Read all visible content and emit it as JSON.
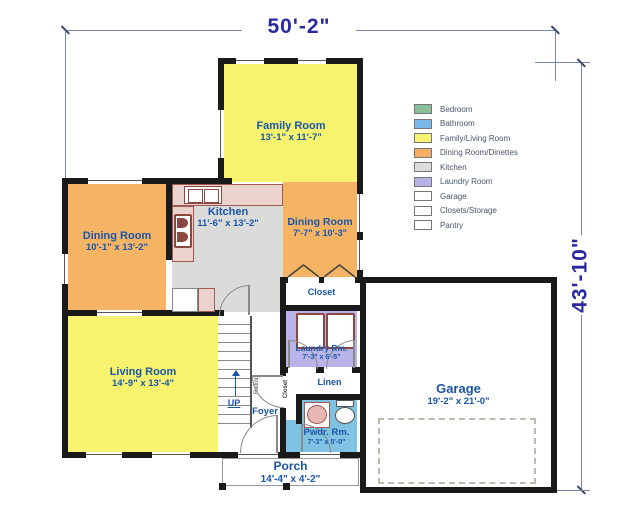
{
  "dimensions": {
    "width_label": "50'-2\"",
    "height_label": "43'-10\""
  },
  "rooms": {
    "family": {
      "name": "Family Room",
      "dims": "13'-1\" x 11'-7\""
    },
    "dining1": {
      "name": "Dining Room",
      "dims": "10'-1\" x 13'-2\""
    },
    "kitchen": {
      "name": "Kitchen",
      "dims": "11'-6\" x 13'-2\""
    },
    "dining2": {
      "name": "Dining Room",
      "dims": "7'-7\" x 10'-3\""
    },
    "living": {
      "name": "Living Room",
      "dims": "14'-9\" x 13'-4\""
    },
    "laundry": {
      "name": "Laundry Rm.",
      "dims": "7'-3\" x 6'-5\""
    },
    "powder": {
      "name": "Pwdr. Rm.",
      "dims": "7'-3\" x 5'-0\""
    },
    "garage": {
      "name": "Garage",
      "dims": "19'-2\" x 21'-0\""
    },
    "porch": {
      "name": "Porch",
      "dims": "14'-4\" x 4'-2\""
    },
    "closet": {
      "name": "Closet"
    },
    "linen": {
      "name": "Linen"
    },
    "foyer_closet": {
      "name": "Closet"
    },
    "foyer": {
      "name": "Foyer"
    },
    "stairs": {
      "name": "UP"
    },
    "railing": {
      "name": "Railing"
    }
  },
  "legend": {
    "items": [
      {
        "label": "Bedroom",
        "color": "#8abf9c"
      },
      {
        "label": "Bathroom",
        "color": "#77b7ea"
      },
      {
        "label": "Family/Living Room",
        "color": "#f8f473"
      },
      {
        "label": "Dining Room/Dinettes",
        "color": "#f4ad62"
      },
      {
        "label": "Kitchen",
        "color": "#dcdcdc"
      },
      {
        "label": "Laundry Room",
        "color": "#b7b2e6"
      },
      {
        "label": "Garage",
        "color": "#ffffff"
      },
      {
        "label": "Closets/Storage",
        "color": "#ffffff"
      },
      {
        "label": "Pantry",
        "color": "#ffffff"
      }
    ]
  },
  "colors": {
    "wall": "#1a1a1a",
    "family_living": "#f7f36e",
    "dining": "#f5b364",
    "kitchen": "#dbdbd9",
    "laundry": "#b9b4e7",
    "powder_room": "#7fc2e2",
    "counter": "#ead2cd",
    "room_label": "#1a55aa",
    "dimension_text": "#2a2aa0",
    "dimension_line": "#7a86a8"
  }
}
